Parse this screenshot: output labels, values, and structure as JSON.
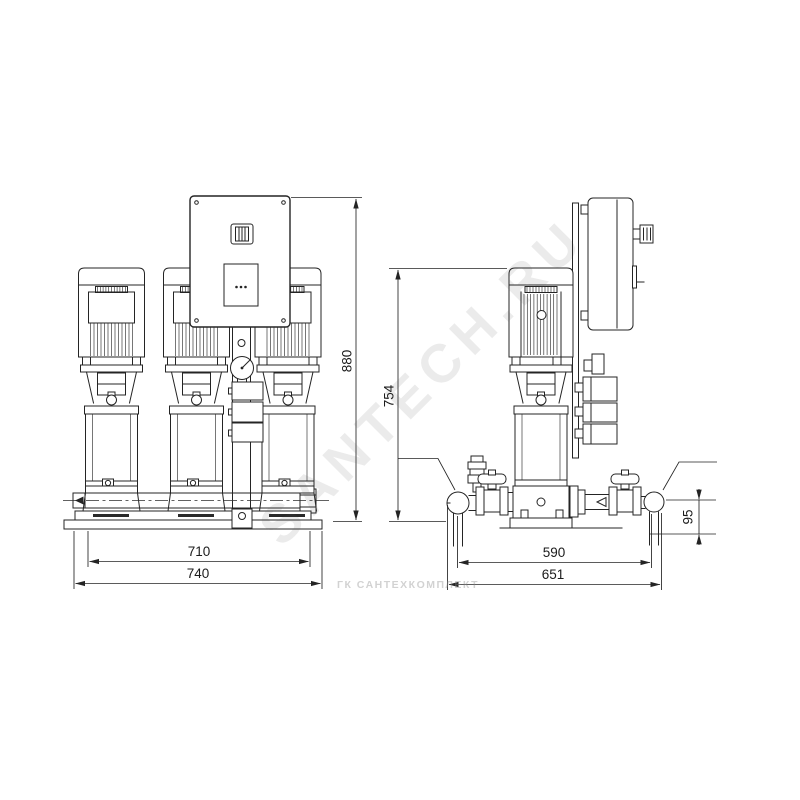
{
  "colors": {
    "line": "#242424",
    "background": "#ffffff",
    "watermark": "#d9d9d9"
  },
  "watermark": {
    "main": "SANTECH.RU",
    "footer": "ГК САНТЕХКОМПЛЕКТ"
  },
  "dimensions": {
    "front": {
      "height": "880",
      "inner_width": "710",
      "overall_width": "740"
    },
    "side": {
      "height": "754",
      "inner_width": "590",
      "overall_width": "651",
      "pipe_axis_height": "95"
    }
  }
}
